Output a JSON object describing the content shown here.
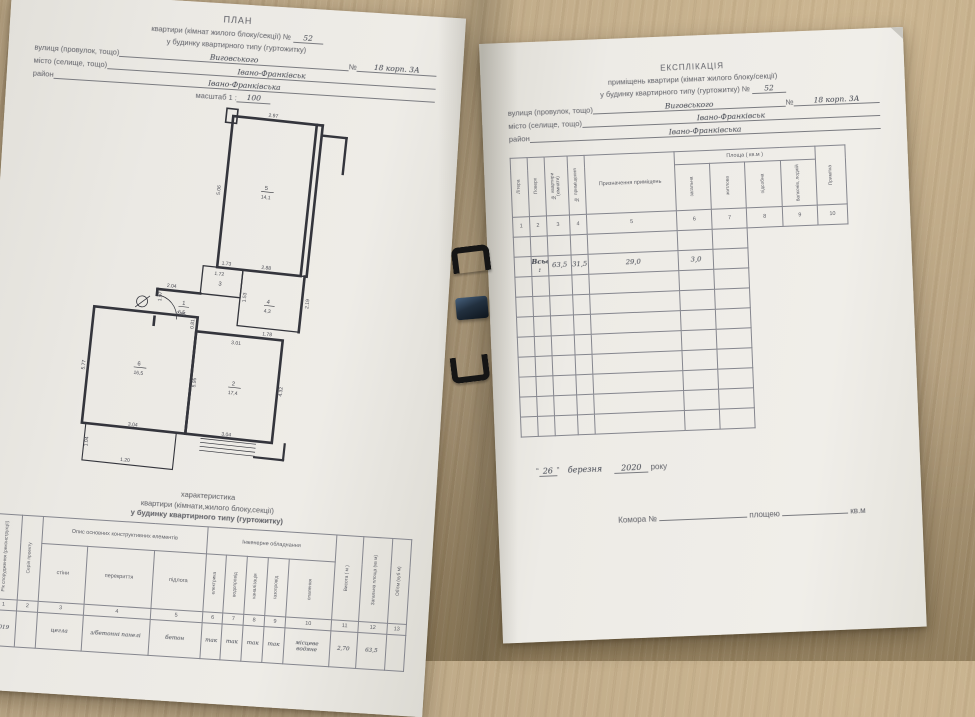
{
  "left_page": {
    "header": {
      "title": "ПЛАН",
      "line2_printed": "квартири (кімнат жилого блоку/секції) №",
      "line2_value": "52",
      "line3": "у будинку квартирного типу (гуртожитку)",
      "street_label": "вулиця (провулок, тощо)",
      "street_value": "Виговського",
      "number_label": "№",
      "number_value": "18 корп. 3А",
      "city_label": "місто (селище, тощо)",
      "city_value": "Івано-Франківськ",
      "district_label": "район",
      "district_value": "Івано-Франківська",
      "scale_label": "масштаб 1 :",
      "scale_value": "100"
    },
    "plan": {
      "rooms": [
        {
          "num": "5",
          "area": "14,1"
        },
        {
          "num": "3",
          "area": "1,7"
        },
        {
          "num": "4",
          "area": "4,3"
        },
        {
          "num": "1",
          "area": "6,5"
        },
        {
          "num": "6",
          "area": "16,5"
        },
        {
          "num": "2",
          "area": "17,4"
        }
      ],
      "dims": [
        "2.97",
        "5.06",
        "2.88",
        "1.73",
        "2.04",
        "1.72",
        "2.85",
        "1.07",
        "2.19",
        "1.53",
        "1.78",
        "0.81",
        "3.01",
        "5.95",
        "5.77",
        "4.32",
        "3.04",
        "3.04",
        "1.04",
        "1.20"
      ]
    },
    "caption_lines": [
      "характеристика",
      "квартири (кімнати,жилого блоку,секції)",
      "у будинку квартирного типу (гуртожитку)"
    ],
    "char_table": {
      "col1": "Рік спорудження (реконструкції)",
      "col2": "Серія проекту",
      "group1": "Опис основних конструктивних елементів",
      "group1_cols": [
        "стіни",
        "перекриття",
        "підлога"
      ],
      "group2": "Інженерне обладнання",
      "group2_cols": [
        "електрика",
        "водопровід",
        "каналізація",
        "газопровід",
        "опалення"
      ],
      "col11": "Висота ( м )",
      "col12": "Загальна площа (кв м)",
      "col13": "Об'єм (куб м)",
      "numbers": [
        "1",
        "2",
        "3",
        "4",
        "5",
        "6",
        "7",
        "8",
        "9",
        "10",
        "11",
        "12",
        "13"
      ],
      "values": [
        "2019",
        "",
        "цегла",
        "з/бетонні панелі",
        "бетон",
        "так",
        "так",
        "так",
        "так",
        "місцеве водяне",
        "2,70",
        "63,5",
        ""
      ]
    }
  },
  "right_page": {
    "header": {
      "title": "ЕКСПЛІКАЦІЯ",
      "line2": "приміщень квартири (кімнат жилого блоку/секції)",
      "line3_printed": "у будинку квартирного типу (гуртожитку)",
      "line3_no": "№",
      "line3_value": "52",
      "street_label": "вулиця (провулок, тощо)",
      "street_value": "Виговського",
      "number_label": "№",
      "number_value": "18 корп. 3А",
      "city_label": "місто (селище, тощо)",
      "city_value": "Івано-Франківськ",
      "district_label": "район",
      "district_value": "Івано-Франківська"
    },
    "expl_table": {
      "headers": {
        "col1": "Літера",
        "col2": "Поверх",
        "col3": "№ квартири (кімнати)",
        "col4": "№ приміщення",
        "col5": "Призначення приміщень",
        "area_group": "Площа ( кв.м )",
        "area_cols": [
          "загальна",
          "житлова",
          "підсобна",
          "балконів, лоджій"
        ],
        "col10": "Примітка"
      },
      "numbers": [
        "1",
        "2",
        "3",
        "4",
        "5",
        "6",
        "7",
        "8",
        "9",
        "10"
      ],
      "litera": "А",
      "floor": "2",
      "apt": "52",
      "rows": [
        {
          "n": "1",
          "name": "коридор",
          "total": "6,5",
          "living": "",
          "aux": "6,5",
          "balc": ""
        },
        {
          "n": "2",
          "name": "житлова",
          "total": "17,4",
          "living": "17,4",
          "aux": "",
          "balc": ""
        },
        {
          "n": "3",
          "name": "туалет",
          "total": "1,7",
          "living": "",
          "aux": "1,7",
          "balc": ""
        },
        {
          "n": "4",
          "name": "ванна",
          "total": "4,3",
          "living": "",
          "aux": "4,3",
          "balc": ""
        },
        {
          "n": "5",
          "name": "житлова",
          "total": "14,1",
          "living": "14,1",
          "aux": "",
          "balc": ""
        },
        {
          "n": "6",
          "name": "кухня",
          "total": "16,5",
          "living": "",
          "aux": "16,5",
          "balc": ""
        },
        {
          "n": "",
          "name": "балкон",
          "total": "3,0",
          "living": "",
          "aux": "",
          "balc": "3,0"
        }
      ],
      "total_row": {
        "label": "Всього :",
        "total": "63,5",
        "living": "31,5",
        "aux": "29,0",
        "balc": "3,0"
      },
      "empty_rows": 8
    },
    "date_line": {
      "q1": "“",
      "day": "26",
      "q2": "”",
      "month": "березня",
      "year": "2020",
      "suffix": "року"
    },
    "storage_line": {
      "label": "Комора  №",
      "area_label": "площею",
      "unit": "кв.м"
    }
  }
}
